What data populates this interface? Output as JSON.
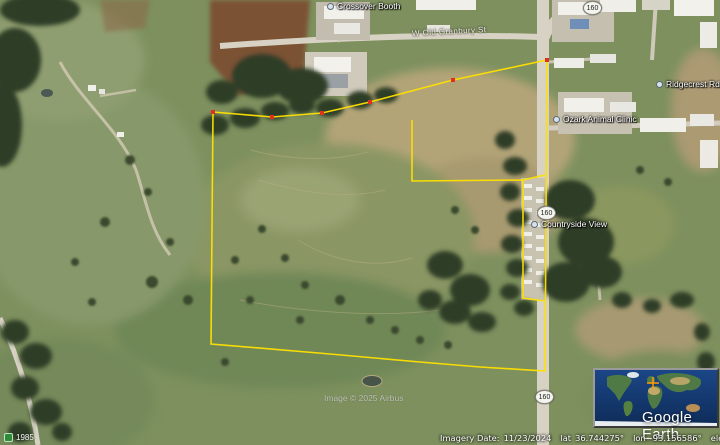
{
  "app": {
    "logo_text": "Google Earth"
  },
  "map": {
    "labels": {
      "booth": "Crossover Booth",
      "top_road": "W Old Granbury St",
      "clinic": "Ozark Animal Clinic",
      "countryside": "Countryside View",
      "ridge": "Ridgecrest Rd",
      "year_marker": "1985",
      "route_number": "160"
    },
    "attribution": "Image © 2025 Airbus"
  },
  "status_bar": {
    "imagery_date_label": "Imagery Date:",
    "imagery_date": "11/23/2024",
    "lat_label": "lat",
    "lat_value": "36.744275°",
    "lon_label": "lon",
    "lon_value": "-93.156586°",
    "elev_label": "elev",
    "elev_value": "1225 ft",
    "eye_alt_label": "eye alt",
    "eye_alt_value": "5489 ft"
  },
  "colors": {
    "boundary": "#ffe100",
    "vertex_marker": "#e0301e",
    "crosshair": "#ff9d00"
  }
}
